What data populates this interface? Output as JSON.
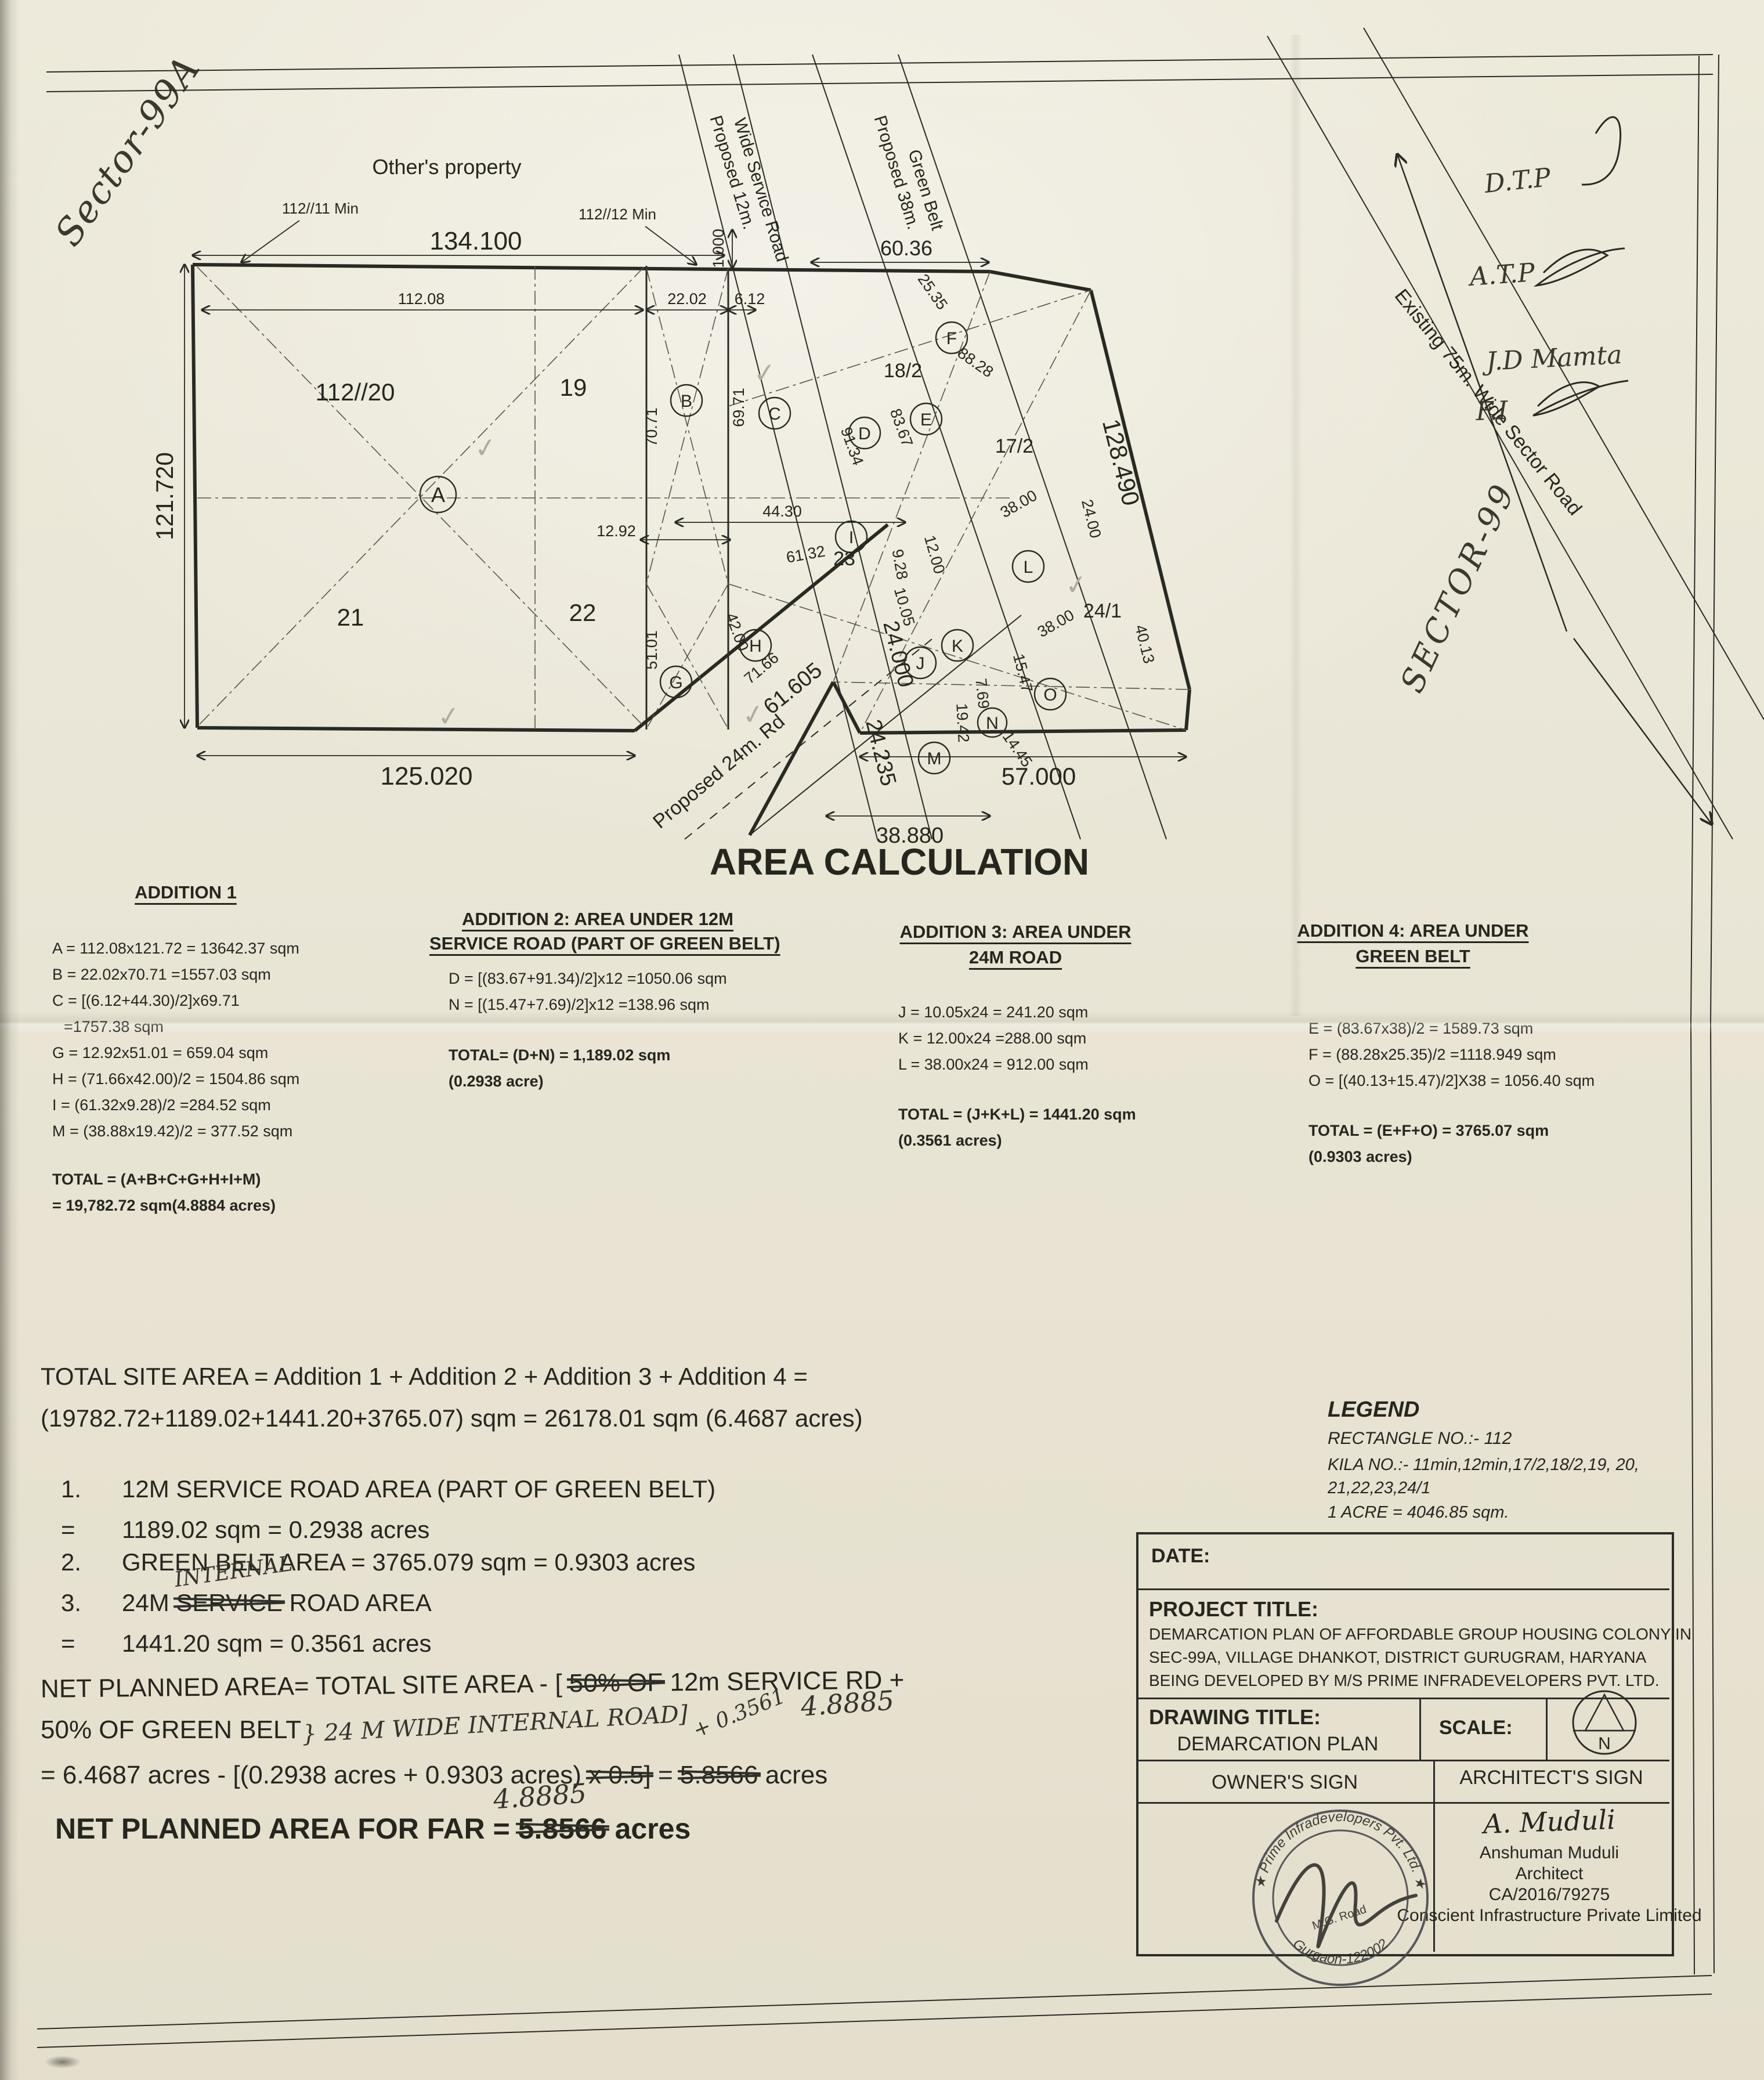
{
  "handwritten": {
    "sector_99a": "Sector-99A",
    "sector_99": "SECTOR-99",
    "note_dtp": "D.T.P",
    "note_atp": "A.T.P",
    "note_jd": "J.D Mamta",
    "note_fi": "F.I",
    "internal": "INTERNAL",
    "road_addition": "} 24 M WIDE INTERNAL ROAD]",
    "plus_value": "+ 0.3561",
    "corrected_acres_inline": "4.8885",
    "corrected_acres_far": "4.8885"
  },
  "plan": {
    "other_property": "Other's property",
    "leader_1": "112//11 Min",
    "leader_2": "112//12 Min",
    "check": "✓",
    "roads": {
      "service_road_1": "Proposed 12m.",
      "service_road_2": "Wide Service Road",
      "green_belt_1": "Proposed 38m.",
      "green_belt_2": "Green Belt",
      "sector_road": "Existing 75m. Wide Sector Road",
      "rd24": "Proposed 24m. Rd"
    },
    "plots": {
      "p112_20": "112//20",
      "p19": "19",
      "p21": "21",
      "p22": "22",
      "p23": "23",
      "p18_2": "18/2",
      "p17_2": "17/2",
      "p24_1": "24/1"
    },
    "points": [
      "A",
      "B",
      "C",
      "D",
      "E",
      "F",
      "G",
      "H",
      "I",
      "J",
      "K",
      "L",
      "M",
      "N",
      "O"
    ],
    "dims": {
      "d134": "134.100",
      "d6036": "60.36",
      "d121": "121.720",
      "d125": "125.020",
      "d11208": "112.08",
      "d2202": "22.02",
      "d612": "6.12",
      "d1000": "1.000",
      "d7071": "70.71",
      "d6971": "69.71",
      "d5101": "51.01",
      "d1292": "12.92",
      "d4430": "44.30",
      "d6132": "61.32",
      "d4200": "42.00",
      "d7166": "71.66",
      "d928": "9.28",
      "d1005": "10.05",
      "d1200": "12.00",
      "d2535": "25.35",
      "d8828": "88.28",
      "d8367": "83.67",
      "d9134": "91.34",
      "d3800a": "38.00",
      "d3800b": "38.00",
      "d2400": "24.00",
      "d4013": "40.13",
      "d1547": "15.47",
      "d769": "7.69",
      "d1942": "19.42",
      "d1445": "14.45",
      "d61605": "61.605",
      "d24000": "24.000",
      "d24235": "24.235",
      "d38880": "38.880",
      "d57000": "57.000",
      "d128490": "128.490"
    }
  },
  "area_calc": {
    "title": "AREA CALCULATION",
    "col1": {
      "heading": "ADDITION 1",
      "lines": [
        "A = 112.08x121.72 = 13642.37 sqm",
        "B = 22.02x70.71  =1557.03 sqm",
        "C = [(6.12+44.30)/2]x69.71",
        "=1757.38 sqm",
        "G = 12.92x51.01  = 659.04 sqm",
        "H = (71.66x42.00)/2  = 1504.86 sqm",
        "I  = (61.32x9.28)/2 =284.52 sqm",
        "M = (38.88x19.42)/2   = 377.52 sqm"
      ],
      "total1": "TOTAL = (A+B+C+G+H+I+M)",
      "total2": "= 19,782.72 sqm(4.8884 acres)"
    },
    "col2": {
      "heading1": "ADDITION 2: AREA UNDER 12M",
      "heading2": "SERVICE ROAD (PART OF GREEN BELT)",
      "lines": [
        "D = [(83.67+91.34)/2]x12 =1050.06 sqm",
        "N = [(15.47+7.69)/2]x12 =138.96 sqm"
      ],
      "total1": "TOTAL= (D+N) = 1,189.02 sqm",
      "total2": "(0.2938 acre)"
    },
    "col3": {
      "heading1": "ADDITION 3: AREA UNDER",
      "heading2": "24M ROAD",
      "lines": [
        "J = 10.05x24 = 241.20 sqm",
        "K = 12.00x24 =288.00 sqm",
        "L = 38.00x24 = 912.00 sqm"
      ],
      "total1": "TOTAL = (J+K+L) = 1441.20 sqm",
      "total2": "(0.3561 acres)"
    },
    "col4": {
      "heading1": "ADDITION 4: AREA UNDER",
      "heading2": "GREEN BELT",
      "lines": [
        "E = (83.67x38)/2 = 1589.73 sqm",
        "F = (88.28x25.35)/2 =1118.949 sqm",
        "O = [(40.13+15.47)/2]X38 = 1056.40 sqm"
      ],
      "total1": "TOTAL = (E+F+O) = 3765.07 sqm",
      "total2": "(0.9303 acres)"
    }
  },
  "summary": {
    "total_line1": "TOTAL SITE AREA = Addition 1 + Addition 2 + Addition 3 + Addition 4 =",
    "total_line2": "(19782.72+1189.02+1441.20+3765.07) sqm = 26178.01 sqm (6.4687 acres)",
    "item1_no": "1.",
    "item1_text": "12M SERVICE ROAD AREA (PART OF GREEN BELT)",
    "item1_eq": "=",
    "item1_val": "1189.02 sqm = 0.2938 acres",
    "item2_no": "2.",
    "item2_text": "GREEN BELT AREA = 3765.079 sqm = 0.9303 acres",
    "item3_no": "3.",
    "item3_pre": "24M ",
    "item3_struck": "SERVICE",
    "item3_post": " ROAD AREA",
    "item3_eq": "=",
    "item3_val": "1441.20 sqm = 0.3561 acres"
  },
  "net": {
    "line1_pre": "NET PLANNED AREA=  TOTAL SITE AREA - [ ",
    "line1_struck": "50% OF",
    "line1_post": " 12m SERVICE RD +",
    "line2": "50% OF GREEN BELT",
    "line3_pre": "= 6.4687 acres - [(0.2938 acres + 0.9303 acres) ",
    "line3_struck": "x 0.5]",
    "line3_mid": " = ",
    "line3_struck2": "5.8566",
    "line3_post": " acres",
    "far_pre": "NET PLANNED AREA FOR FAR = ",
    "far_struck": "5.8566",
    "far_post": " acres"
  },
  "legend": {
    "title": "LEGEND",
    "line1": "RECTANGLE NO.:- 112",
    "line2": "KILA NO.:- 11min,12min,17/2,18/2,19, 20,",
    "line3": "21,22,23,24/1",
    "line4": "1 ACRE = 4046.85 sqm."
  },
  "title_block": {
    "date_label": "DATE:",
    "project_label": "PROJECT TITLE:",
    "project_line1": "DEMARCATION PLAN OF AFFORDABLE GROUP HOUSING COLONY IN",
    "project_line2": "SEC-99A, VILLAGE DHANKOT, DISTRICT GURUGRAM, HARYANA",
    "project_line3": "BEING DEVELOPED BY M/S PRIME INFRADEVELOPERS PVT. LTD.",
    "drawing_label": "DRAWING TITLE:",
    "drawing_value": "DEMARCATION PLAN",
    "scale_label": "SCALE:",
    "north_letter": "N",
    "owner_sign": "OWNER'S SIGN",
    "architect_sign": "ARCHITECT'S SIGN",
    "architect_script": "A. Muduli",
    "architect_name": "Anshuman Muduli",
    "architect_title": "Architect",
    "architect_reg": "CA/2016/79275",
    "architect_company": "Conscient Infrastructure Private Limited",
    "stamp_top": "★ Prime Infradevelopers Pvt. Ltd. ★",
    "stamp_bottom": "Gurgaon-122002",
    "stamp_center": "M.G. Road"
  }
}
